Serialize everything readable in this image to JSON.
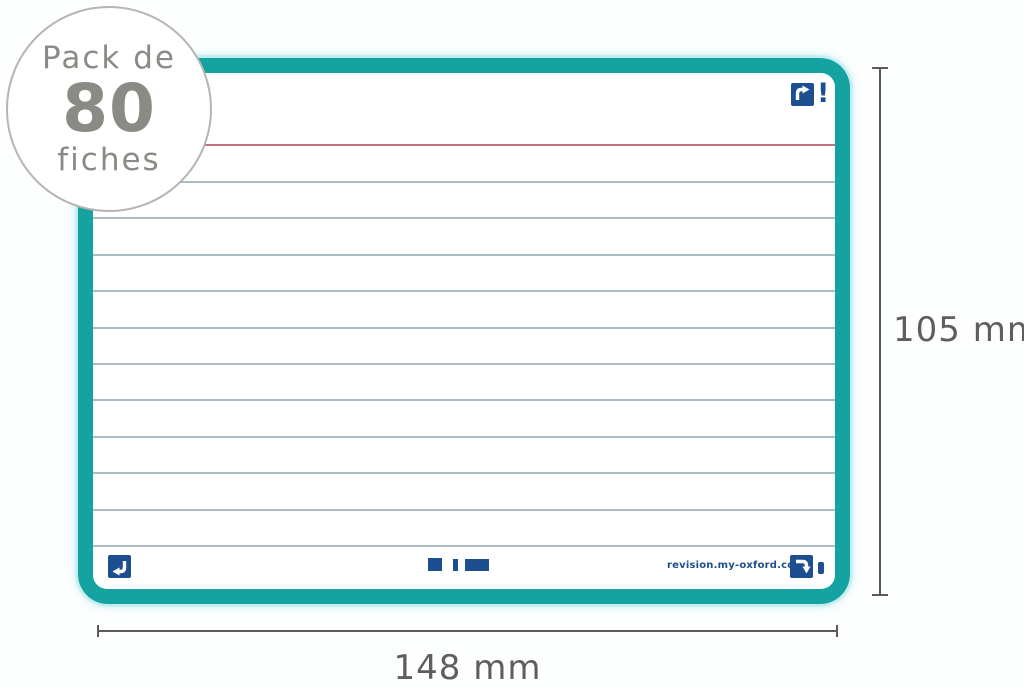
{
  "badge": {
    "line1": "Pack de",
    "line2": "80",
    "line3": "fiches",
    "text_color": "#8b8b85",
    "border_color": "#b5b5b1"
  },
  "card": {
    "border_color": "#14a3a1",
    "glow_color": "#b2e9ed",
    "background": "#ffffff",
    "accent_navy": "#1d4e8f",
    "ruling": {
      "red_line_color": "#c4717e",
      "blue_line_color": "#a9bdc7",
      "blue_line_count": 11
    },
    "footer": {
      "url": "revision.my-oxford.com"
    },
    "icons": {
      "top_right": "corner-scan-arrow-icon",
      "top_right_mark": "exclamation-mark",
      "bottom_left": "corner-scan-arrow-icon",
      "bottom_right": "corner-scan-arrow-icon",
      "bottom_right_mark": "exclamation-dot",
      "center": "calibration-marks"
    },
    "exclamation": "!"
  },
  "dimensions": {
    "height_label": "105 mm",
    "width_label": "148 mm",
    "line_color": "#5a5a5a",
    "text_color": "#5e5e5e"
  }
}
